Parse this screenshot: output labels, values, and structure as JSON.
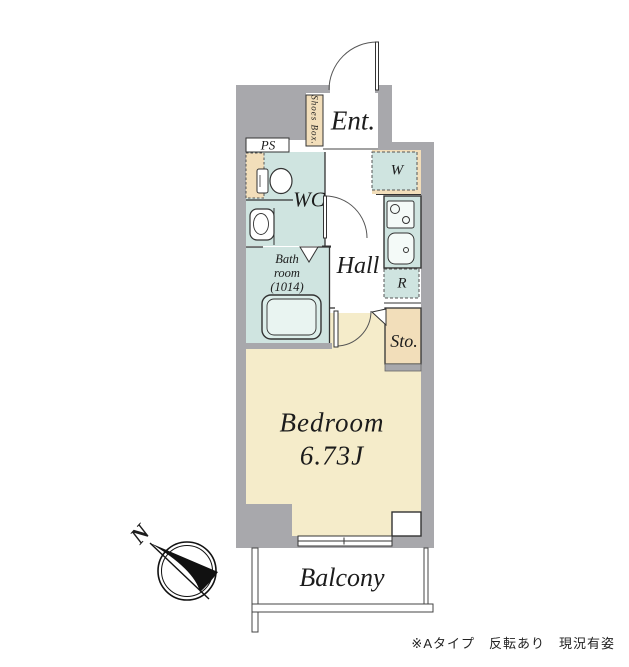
{
  "plan": {
    "rooms": {
      "entrance": {
        "label": "Ent."
      },
      "shoes_box": {
        "label": "Shoes Box."
      },
      "ps": {
        "label": "PS"
      },
      "wc": {
        "label": "WC"
      },
      "bathroom": {
        "l1": "Bath",
        "l2": "room",
        "l3": "(1014)"
      },
      "hall": {
        "label": "Hall"
      },
      "washer": {
        "label": "W"
      },
      "refrigerator": {
        "label": "R"
      },
      "storage": {
        "label": "Sto."
      },
      "bedroom": {
        "label": "Bedroom",
        "size": "6.73J"
      },
      "balcony": {
        "label": "Balcony"
      }
    },
    "compass": {
      "label": "N"
    },
    "footnote": "※Aタイプ　反転あり　現況有姿",
    "colors": {
      "wall": "#a8a8ac",
      "wet_area": "#cfe4e0",
      "storage_tan": "#f2deba",
      "bedroom_cream": "#f5ecca",
      "line": "#333333"
    }
  }
}
